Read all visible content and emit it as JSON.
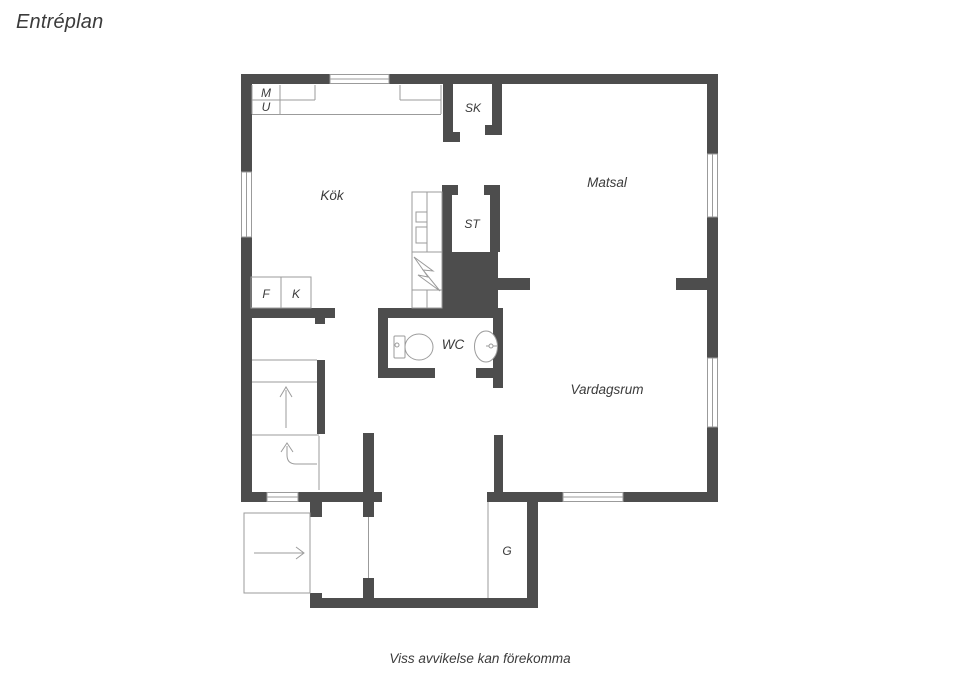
{
  "title": "Entréplan",
  "footer": {
    "disclaimer": "Viss avvikelse kan förekomma"
  },
  "colors": {
    "wall": "#4d4d4d",
    "line": "#9b9b9b",
    "text": "#3b3b3b",
    "bg": "#ffffff"
  },
  "labels": {
    "kok": "Kök",
    "matsal": "Matsal",
    "vardagsrum": "Vardagsrum",
    "wc": "WC",
    "sk": "SK",
    "st": "ST",
    "g": "G",
    "m": "M",
    "u": "U",
    "f": "F",
    "k": "K"
  }
}
